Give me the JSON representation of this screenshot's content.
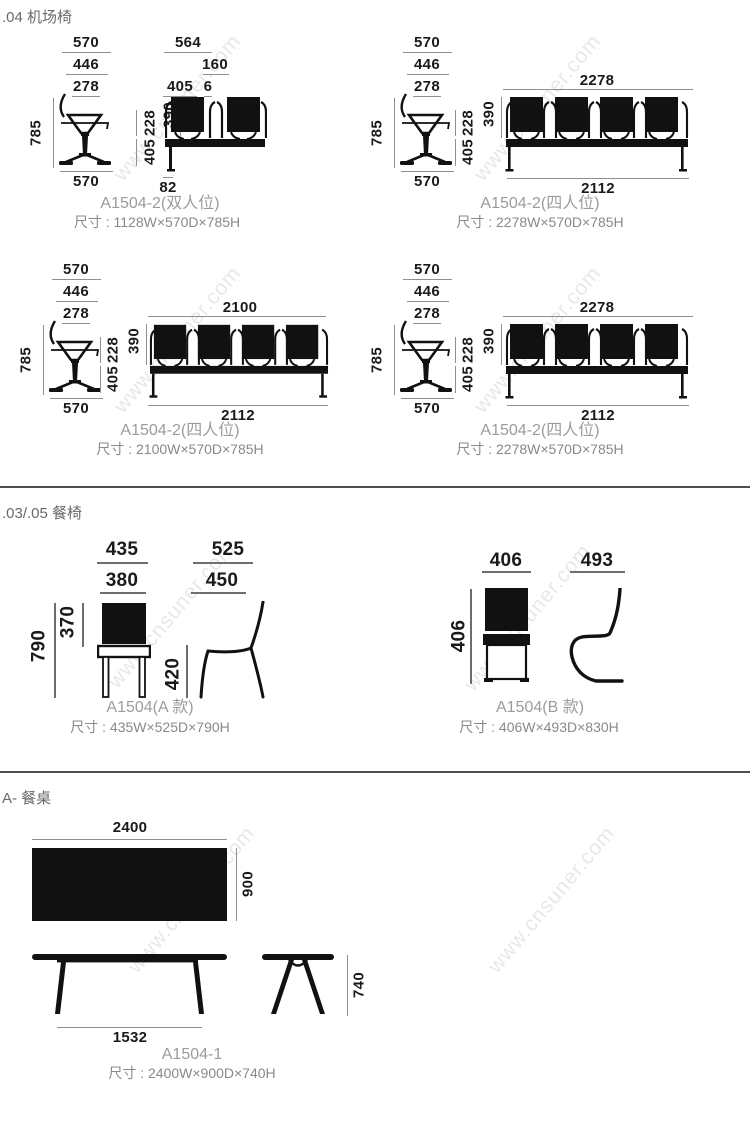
{
  "watermark": "www.cnsuner.com",
  "airport": {
    "title": ".04 机场椅",
    "side": {
      "d1": "570",
      "d2": "446",
      "d3": "278",
      "h": "785",
      "b": "570"
    },
    "p1": {
      "top": "564",
      "sub": "160",
      "seat": "405",
      "gap": "6",
      "v390": "390",
      "v228": "228",
      "v405": "405",
      "leg": "82",
      "label": "A1504-2(双人位)",
      "size": "尺寸 : 1128W×570D×785H"
    },
    "p2": {
      "top": "2278",
      "v390": "390",
      "v228": "228",
      "v405": "405",
      "bottom": "2112",
      "label": "A1504-2(四人位)",
      "size": "尺寸 : 2278W×570D×785H"
    },
    "p3": {
      "top": "2100",
      "v390": "390",
      "v228": "228",
      "v405": "405",
      "bottom": "2112",
      "label": "A1504-2(四人位)",
      "size": "尺寸 : 2100W×570D×785H"
    },
    "p4": {
      "top": "2278",
      "v390": "390",
      "v228": "228",
      "v405": "405",
      "bottom": "2112",
      "label": "A1504-2(四人位)",
      "size": "尺寸 : 2278W×570D×785H"
    }
  },
  "dining": {
    "title": ".03/.05 餐椅",
    "a": {
      "w1": "435",
      "w2": "380",
      "h": "790",
      "back": "370",
      "seat": "420",
      "d1": "525",
      "d2": "450",
      "label": "A1504(A 款)",
      "size": "尺寸 : 435W×525D×790H"
    },
    "b": {
      "w": "406",
      "h": "406",
      "d": "493",
      "label": "A1504(B 款)",
      "size": "尺寸 : 406W×493D×830H"
    }
  },
  "table": {
    "title": "A- 餐桌",
    "w": "2400",
    "d": "900",
    "legspan": "1532",
    "h": "740",
    "label": "A1504-1",
    "size": "尺寸 : 2400W×900D×740H"
  }
}
